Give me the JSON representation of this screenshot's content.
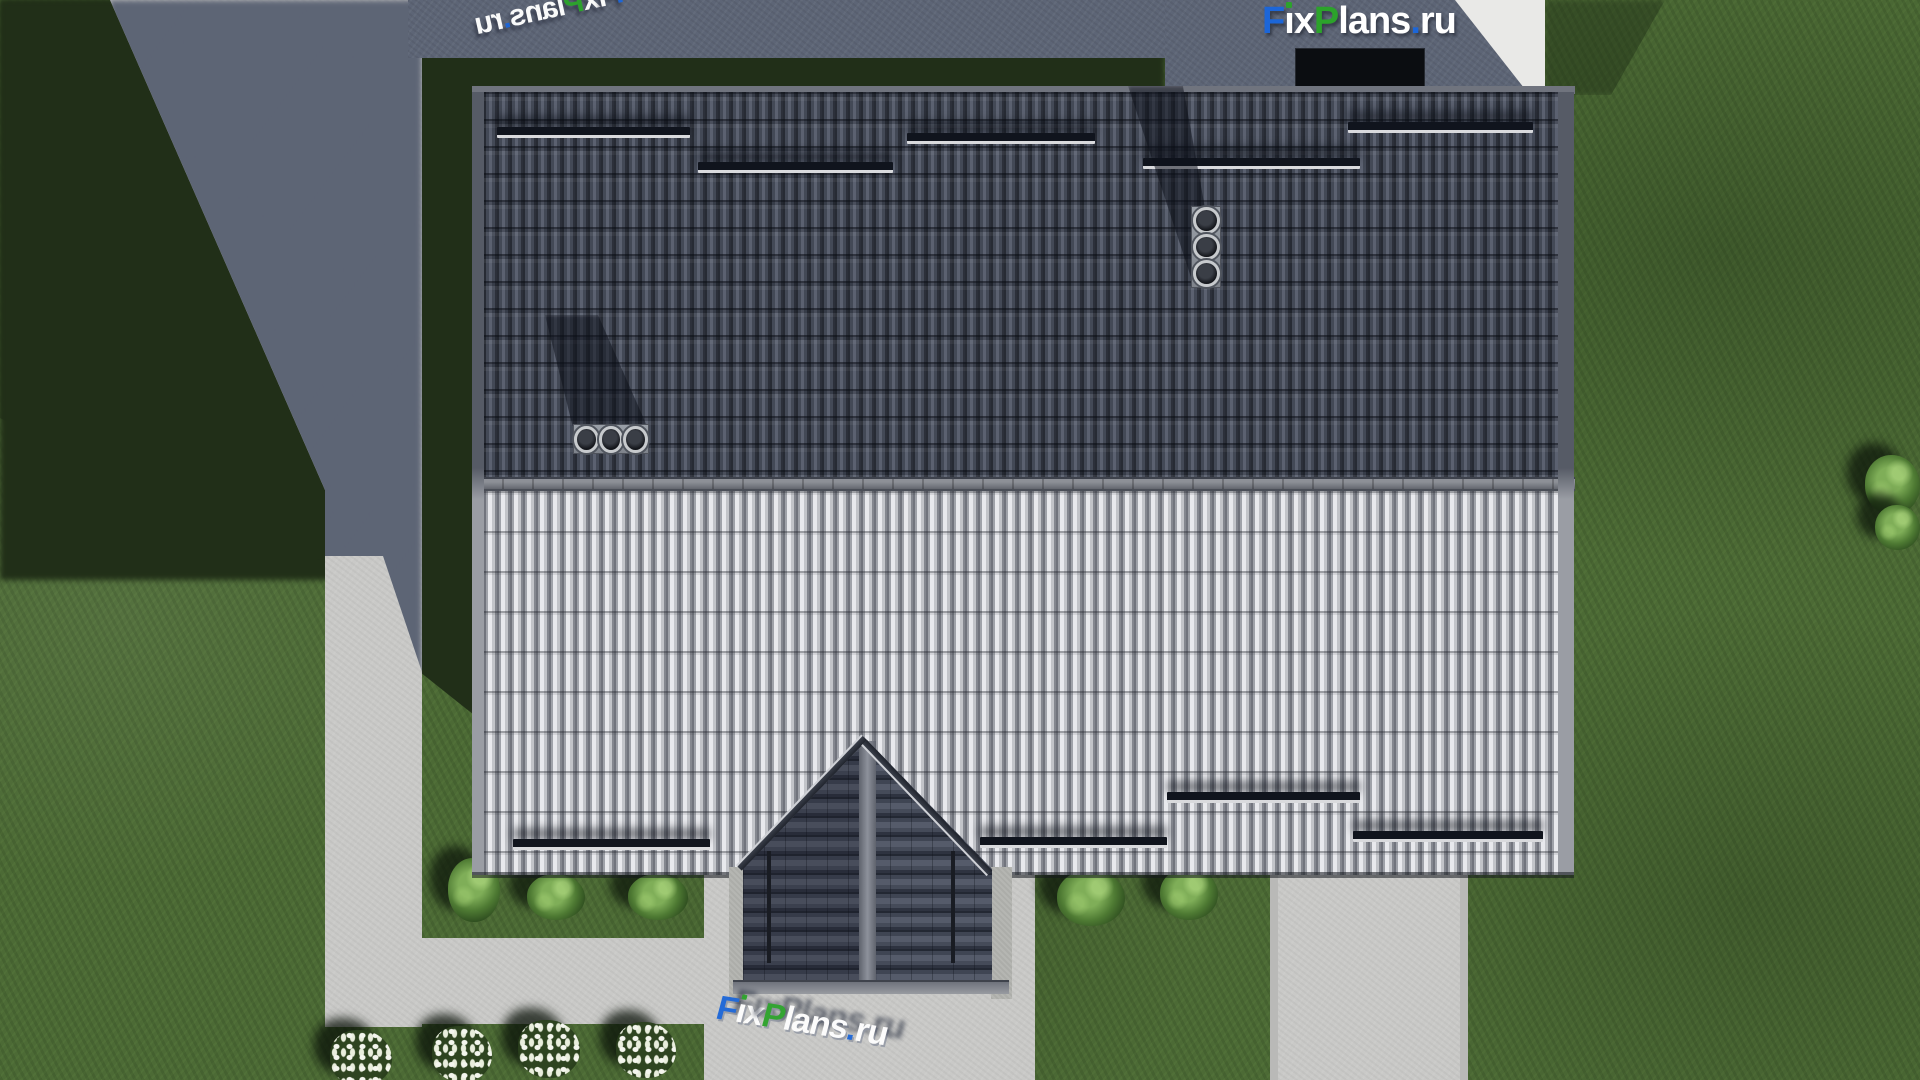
{
  "brand": {
    "name": "FixPlans.ru",
    "parts": [
      {
        "text": "F",
        "color": "#1c66d8"
      },
      {
        "text": "i",
        "color": "#ffffff",
        "dot_color": "#2ca32b"
      },
      {
        "text": "x",
        "color": "#ffffff"
      },
      {
        "text": "P",
        "color": "#2ca32b"
      },
      {
        "text": "lans",
        "color": "#ffffff"
      },
      {
        "text": ".",
        "color": "#1c66d8"
      },
      {
        "text": "ru",
        "color": "#ffffff"
      }
    ]
  },
  "watermarks": {
    "top_right_logo_text": "FixPlans.ru",
    "ground_top_left_text": "FixPlans.ru",
    "ground_bottom_text": "FixPlans.ru"
  },
  "scene": {
    "description": "Aerial top-down 3D render of a gabled-roof house with entrance porch, lawn, paths and flower beds",
    "colors": {
      "grass_lit": "#4c6a35",
      "grass_shadow": "#212f18",
      "pavement_lit": "#c9c9c7",
      "pavement_shadow": "#5d6576",
      "pavement_bright": "#e9e9e7",
      "roof_dark_slope": "#3a4050",
      "roof_light_slope": "#b7b9bf",
      "ridge": "#7b7e86",
      "porch_tiles": "#454b59",
      "snow_guard": "#10141d",
      "brand_blue": "#1c66d8",
      "brand_green": "#2ca32b"
    },
    "objects": {
      "roof_vents": 2,
      "pipes_per_vent": 3,
      "snow_guards_upper_slope": 5,
      "snow_guards_lower_slope": 4,
      "bushes": 5,
      "flower_beds": 4
    }
  }
}
